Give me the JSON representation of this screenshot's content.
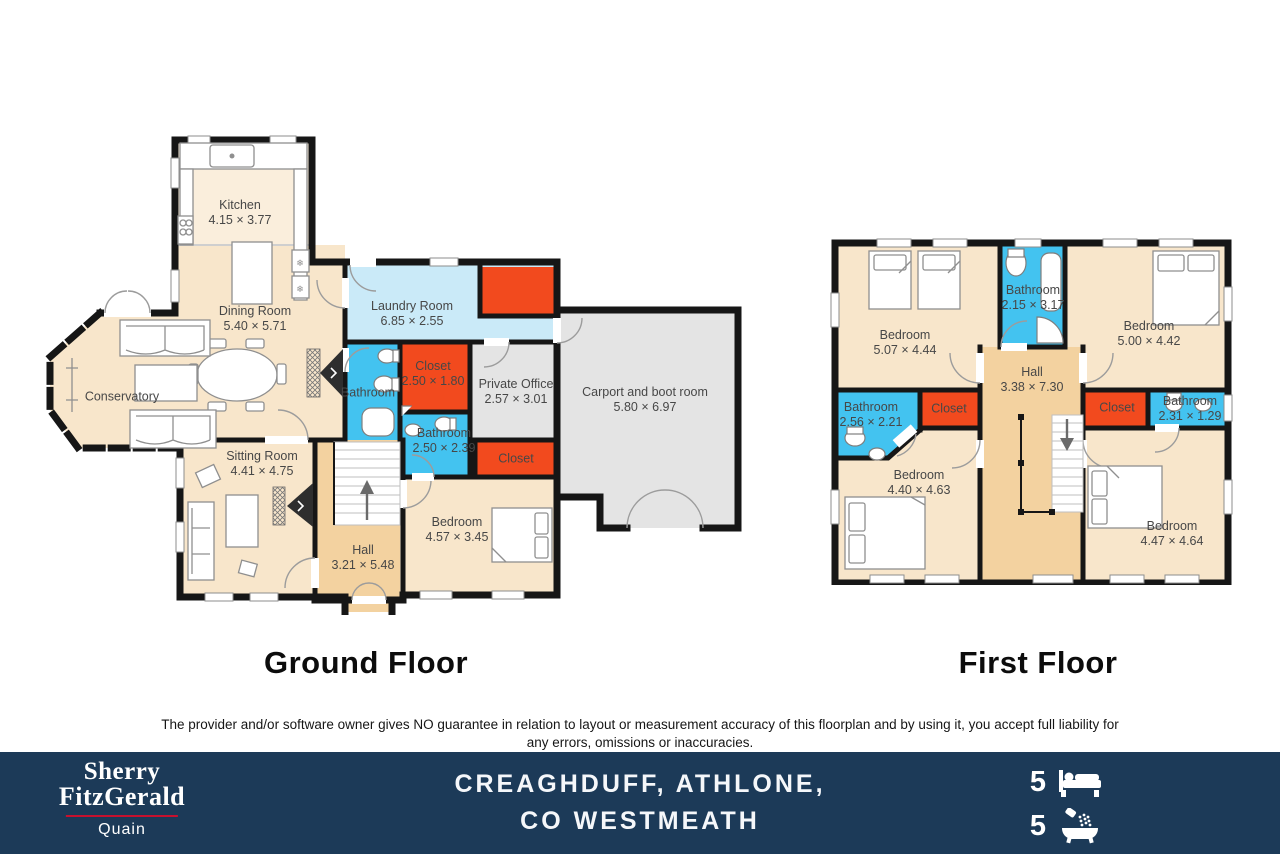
{
  "ground_floor": {
    "title": "Ground Floor",
    "rooms": {
      "kitchen": {
        "name": "Kitchen",
        "dims": "4.15 × 3.77"
      },
      "dining": {
        "name": "Dining Room",
        "dims": "5.40 × 5.71"
      },
      "conservatory": {
        "name": "Conservatory"
      },
      "laundry": {
        "name": "Laundry Room",
        "dims": "6.85 × 2.55"
      },
      "bathroom1": {
        "name": "Bathroom"
      },
      "closet1": {
        "name": "Closet",
        "dims": "2.50 × 1.80"
      },
      "private_office": {
        "name": "Private Office",
        "dims": "2.57 × 3.01"
      },
      "bathroom2": {
        "name": "Bathroom",
        "dims": "2.50 × 2.39"
      },
      "closet2": {
        "name": "Closet"
      },
      "carport": {
        "name": "Carport and boot room",
        "dims": "5.80 × 6.97"
      },
      "sitting": {
        "name": "Sitting Room",
        "dims": "4.41 × 4.75"
      },
      "hall": {
        "name": "Hall",
        "dims": "3.21 × 5.48"
      },
      "bedroom": {
        "name": "Bedroom",
        "dims": "4.57 × 3.45"
      }
    }
  },
  "first_floor": {
    "title": "First Floor",
    "rooms": {
      "bedroom_tl": {
        "name": "Bedroom",
        "dims": "5.07 × 4.44"
      },
      "bathroom_top": {
        "name": "Bathroom",
        "dims": "2.15 × 3.17"
      },
      "bedroom_tr": {
        "name": "Bedroom",
        "dims": "5.00 × 4.42"
      },
      "hall": {
        "name": "Hall",
        "dims": "3.38 × 7.30"
      },
      "bathroom_left": {
        "name": "Bathroom",
        "dims": "2.56 × 2.21"
      },
      "closet_left": {
        "name": "Closet"
      },
      "closet_right": {
        "name": "Closet"
      },
      "bathroom_right": {
        "name": "Bathroom",
        "dims": "2.31 × 1.29"
      },
      "bedroom_bl": {
        "name": "Bedroom",
        "dims": "4.40 × 4.63"
      },
      "bedroom_br": {
        "name": "Bedroom",
        "dims": "4.47 × 4.64"
      }
    }
  },
  "disclaimer": "The provider and/or software owner gives NO guarantee in relation to layout or measurement accuracy of this floorplan and by using it, you accept full liability for any errors, omissions or inaccuracies.",
  "footer": {
    "brand_line1": "Sherry",
    "brand_line2": "FitzGerald",
    "brand_sub": "Quain",
    "property_line1": "CREAGHDUFF, ATHLONE,",
    "property_line2": "CO WESTMEATH",
    "bed_count": "5",
    "bath_count": "5"
  },
  "colors": {
    "room_fill": "#F8E6CB",
    "kitchen_fill": "#FAEEDC",
    "hall_fill": "#F3D2A0",
    "laundry_fill": "#CAEAF8",
    "bath_fill": "#43C3F0",
    "closet_fill": "#F24A1E",
    "carport_fill": "#E4E4E4",
    "wall": "#161616",
    "footer_bg": "#1C3A58",
    "brand_red": "#C8102E"
  }
}
